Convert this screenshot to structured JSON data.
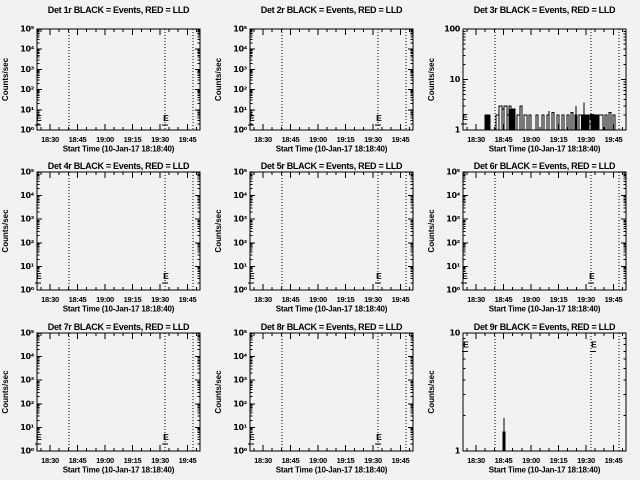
{
  "colors": {
    "background": "#f2f2f2",
    "foreground": "#000000"
  },
  "shared": {
    "ylabel": "Counts/sec",
    "xlabel": "Start Time (10-Jan-17 18:18:40)",
    "xticks": [
      "18:30",
      "18:45",
      "19:00",
      "19:15",
      "19:30",
      "19:45"
    ],
    "eclipse_label": "E",
    "legend_note": "BLACK = Events, RED = LLD"
  },
  "chart_data": [
    {
      "id": "det-1r",
      "type": "line",
      "title": "Det 1r BLACK = Events, RED = LLD",
      "ylim": [
        1,
        100000
      ],
      "yticks": [
        "10⁰",
        "10¹",
        "10²",
        "10³",
        "10⁴",
        "10⁵"
      ],
      "vlines_px": [
        32,
        128,
        156
      ],
      "eclipse": [
        {
          "x": 2,
          "v": 4
        },
        {
          "x": 129,
          "v": 4
        }
      ],
      "segments": [],
      "fills": [],
      "spikes": []
    },
    {
      "id": "det-2r",
      "type": "line",
      "title": "Det 2r BLACK = Events, RED = LLD",
      "ylim": [
        1,
        100000
      ],
      "yticks": [
        "10⁰",
        "10¹",
        "10²",
        "10³",
        "10⁴",
        "10⁵"
      ],
      "vlines_px": [
        32,
        128,
        156
      ],
      "eclipse": [
        {
          "x": 2,
          "v": 4
        },
        {
          "x": 129,
          "v": 4
        }
      ],
      "segments": [],
      "fills": [],
      "spikes": []
    },
    {
      "id": "det-3r",
      "type": "line",
      "title": "Det 3r BLACK = Events, RED = LLD",
      "ylim": [
        1,
        100
      ],
      "yticks": [
        "1",
        "10",
        "100"
      ],
      "vlines_px": [
        32,
        128,
        156
      ],
      "eclipse": [
        {
          "x": 2,
          "v": 1.8
        },
        {
          "x": 129,
          "v": 1.8
        }
      ],
      "segments": [
        [
          22,
          27,
          2
        ],
        [
          33,
          36,
          2
        ],
        [
          36,
          39,
          3
        ],
        [
          39,
          41,
          2.6
        ],
        [
          41,
          44,
          3
        ],
        [
          44,
          46,
          2
        ],
        [
          46,
          48,
          3
        ],
        [
          48,
          52,
          2.6
        ],
        [
          54,
          57,
          2
        ],
        [
          57,
          59,
          3
        ],
        [
          61,
          64,
          2
        ],
        [
          66,
          68,
          2
        ],
        [
          73,
          75,
          2
        ],
        [
          79,
          81,
          2
        ],
        [
          84,
          86,
          2
        ],
        [
          89,
          91,
          2.2
        ],
        [
          94,
          96,
          2
        ],
        [
          99,
          101,
          2
        ],
        [
          104,
          106,
          2
        ],
        [
          108,
          110,
          2.2
        ],
        [
          112,
          114,
          2
        ],
        [
          116,
          126,
          2
        ],
        [
          128,
          136,
          2
        ],
        [
          136,
          140,
          2
        ],
        [
          142,
          144,
          2
        ],
        [
          146,
          148,
          2.2
        ],
        [
          150,
          152,
          2
        ]
      ],
      "fills": [
        [
          22,
          27,
          2
        ],
        [
          46,
          52,
          2.6
        ],
        [
          118,
          126,
          2
        ],
        [
          128,
          136,
          2
        ]
      ],
      "spikes": [
        {
          "x": 86,
          "v": 2.4
        },
        {
          "x": 113,
          "v": 3
        },
        {
          "x": 121,
          "v": 3.5
        }
      ]
    },
    {
      "id": "det-4r",
      "type": "line",
      "title": "Det 4r BLACK = Events, RED = LLD",
      "ylim": [
        1,
        100000
      ],
      "yticks": [
        "10⁰",
        "10¹",
        "10²",
        "10³",
        "10⁴",
        "10⁵"
      ],
      "vlines_px": [
        32,
        128,
        156
      ],
      "eclipse": [
        {
          "x": 2,
          "v": 4
        },
        {
          "x": 129,
          "v": 4
        }
      ],
      "segments": [],
      "fills": [],
      "spikes": []
    },
    {
      "id": "det-5r",
      "type": "line",
      "title": "Det 5r BLACK = Events, RED = LLD",
      "ylim": [
        1,
        100000
      ],
      "yticks": [
        "10⁰",
        "10¹",
        "10²",
        "10³",
        "10⁴",
        "10⁵"
      ],
      "vlines_px": [
        32,
        128,
        156
      ],
      "eclipse": [
        {
          "x": 2,
          "v": 4
        },
        {
          "x": 129,
          "v": 4
        }
      ],
      "segments": [],
      "fills": [],
      "spikes": []
    },
    {
      "id": "det-6r",
      "type": "line",
      "title": "Det 6r BLACK = Events, RED = LLD",
      "ylim": [
        1,
        100000
      ],
      "yticks": [
        "10⁰",
        "10¹",
        "10²",
        "10³",
        "10⁴",
        "10⁵"
      ],
      "vlines_px": [
        32,
        128,
        156
      ],
      "eclipse": [
        {
          "x": 2,
          "v": 4
        },
        {
          "x": 129,
          "v": 4
        }
      ],
      "segments": [],
      "fills": [],
      "spikes": []
    },
    {
      "id": "det-7r",
      "type": "line",
      "title": "Det 7r BLACK = Events, RED = LLD",
      "ylim": [
        1,
        100000
      ],
      "yticks": [
        "10⁰",
        "10¹",
        "10²",
        "10³",
        "10⁴",
        "10⁵"
      ],
      "vlines_px": [
        32,
        128,
        156
      ],
      "eclipse": [
        {
          "x": 2,
          "v": 4
        },
        {
          "x": 129,
          "v": 4
        }
      ],
      "segments": [],
      "fills": [],
      "spikes": []
    },
    {
      "id": "det-8r",
      "type": "line",
      "title": "Det 8r BLACK = Events, RED = LLD",
      "ylim": [
        1,
        100000
      ],
      "yticks": [
        "10⁰",
        "10¹",
        "10²",
        "10³",
        "10⁴",
        "10⁵"
      ],
      "vlines_px": [
        32,
        128,
        156
      ],
      "eclipse": [
        {
          "x": 2,
          "v": 4
        },
        {
          "x": 129,
          "v": 4
        }
      ],
      "segments": [],
      "fills": [],
      "spikes": []
    },
    {
      "id": "det-9r",
      "type": "line",
      "title": "Det 9r BLACK = Events, RED = LLD",
      "ylim": [
        1,
        10
      ],
      "yticks": [
        "1",
        "10"
      ],
      "vlines_px": [
        32,
        128,
        156
      ],
      "eclipse": [
        {
          "x": 3,
          "v": 8
        },
        {
          "x": 131,
          "v": 8
        }
      ],
      "segments": [
        [
          40,
          42,
          1.45
        ]
      ],
      "fills": [
        [
          40,
          42,
          1.45
        ]
      ],
      "spikes": [
        {
          "x": 41,
          "v": 1.9
        }
      ]
    }
  ]
}
